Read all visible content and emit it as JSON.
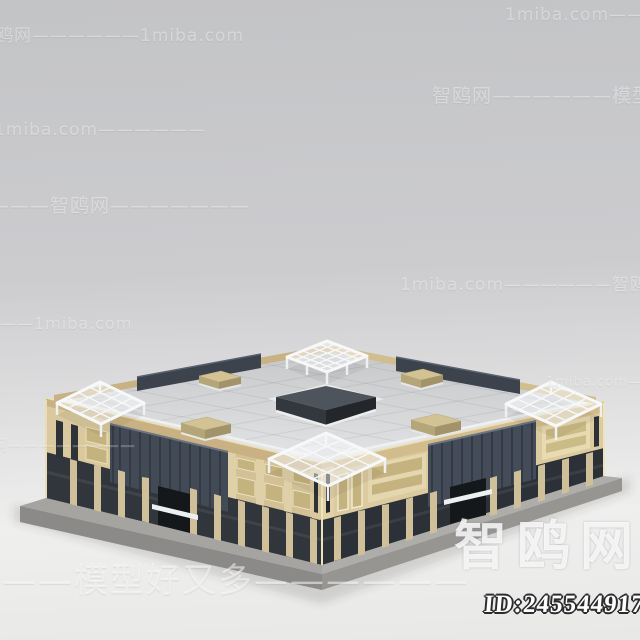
{
  "watermarks": {
    "brand_large": "智鸥网",
    "model_id": "ID:245544917",
    "rows": [
      {
        "text": "1miba.com——————"
      },
      {
        "text": "智鸥网——————1miba.com"
      },
      {
        "text": "智鸥网——————模型好又多"
      },
      {
        "text": "1miba.com——————"
      },
      {
        "text": "———智鸥网———————"
      },
      {
        "text": "——————1miba.com"
      },
      {
        "text": "1miba.com——————智鸥网"
      },
      {
        "text": "1miba.com————"
      },
      {
        "text": "网————————"
      },
      {
        "text": "———模型好又多——————"
      }
    ]
  },
  "colors": {
    "bg-top": "#c3c4c6",
    "bg-mid": "#cccccf",
    "bg-bottom": "#efefee",
    "roof": "#d5d6d8",
    "wall": "#d2c196",
    "wall-light": "#dccaa0",
    "window": "#c4b37e",
    "storefront": "#31363c",
    "louver": "#414a55",
    "tan": "#c9b183",
    "pergola": "#f6f8f9",
    "plinth": "#8b8a88",
    "skylight": "#4e545b"
  }
}
